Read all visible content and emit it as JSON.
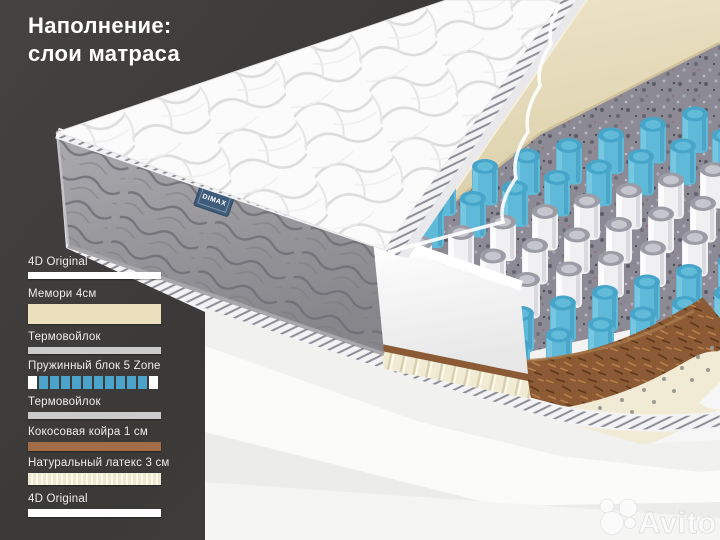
{
  "title": {
    "line1": "Наполнение:",
    "line2": "слои матраса"
  },
  "brand_label": "DIMAX",
  "watermark_text": "Avito",
  "legend": {
    "items": [
      {
        "label": "4D Original",
        "kind": "bar",
        "color": "#ffffff",
        "height": 7
      },
      {
        "label": "Мемори 4см",
        "kind": "bar",
        "color": "#ebdfbe",
        "height": 20
      },
      {
        "label": "Термовойлок",
        "kind": "bar",
        "color": "#cbcbcb",
        "height": 7
      },
      {
        "label": "Пружинный блок 5 Zone",
        "kind": "springs",
        "spring_color": "#4ba3c9",
        "end_color": "#ffffff",
        "count": 12,
        "height": 13
      },
      {
        "label": "Термовойлок",
        "kind": "bar",
        "color": "#cbcbcb",
        "height": 7
      },
      {
        "label": "Кокосовая койра 1 см",
        "kind": "bar",
        "color": "#a26c46",
        "height": 9
      },
      {
        "label": "Натуральный латекс 3 см",
        "kind": "striped",
        "color": "#efe8d0",
        "stripe_color": "#fbf7ea",
        "height": 12
      },
      {
        "label": "4D Original",
        "kind": "bar",
        "color": "#ffffff",
        "height": 8
      }
    ]
  },
  "illustration": {
    "layer_colors": {
      "cover": "#fbfbfb",
      "side": "#9c9ca0",
      "memory_foam": "#e8dfc0",
      "felt": "#8b8a95",
      "springs_blue": "#5fb9d9",
      "springs_white": "#f2f2f4",
      "coir": "#8c5a34",
      "latex": "#f1ebd6",
      "panel_dark": "#3f3d3b",
      "brand_blue": "#3e5c7a"
    }
  }
}
